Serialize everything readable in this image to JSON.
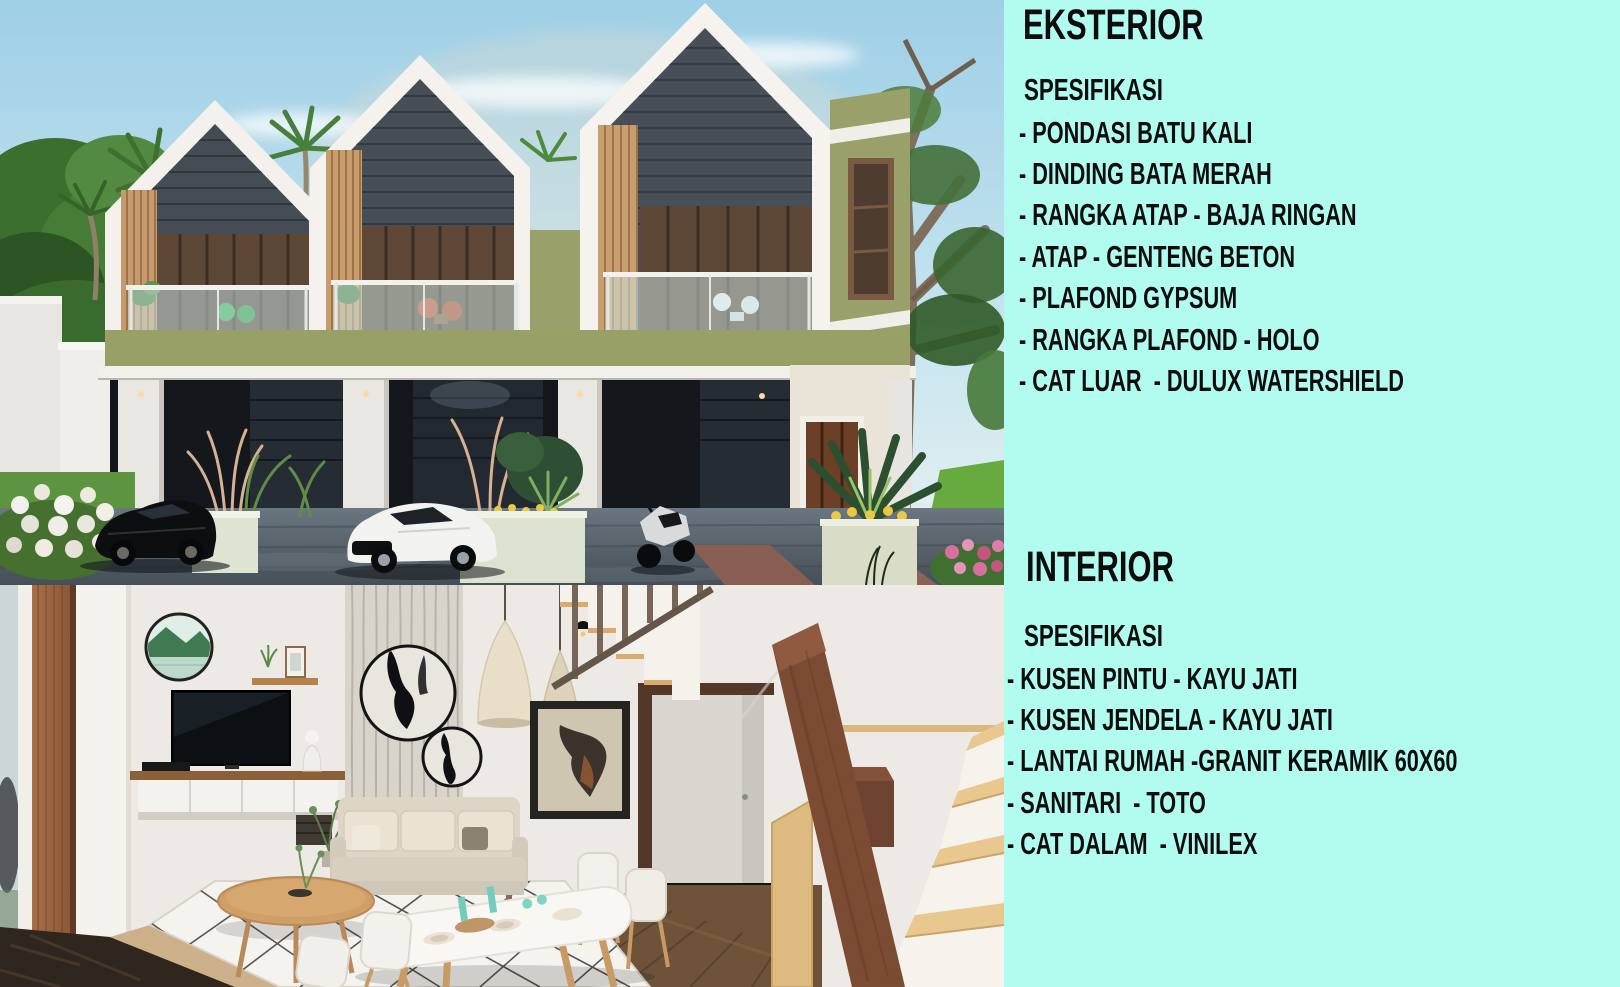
{
  "panel": {
    "background_color": "#B2FCEF",
    "text_color": "#0D0D0D",
    "eksterior": {
      "title": "EKSTERIOR",
      "subtitle": "SPESIFIKASI",
      "items": [
        "- PONDASI BATU KALI",
        "- DINDING BATA MERAH",
        "- RANGKA ATAP - BAJA RINGAN",
        "- ATAP - GENTENG BETON",
        "- PLAFOND GYPSUM",
        "- RANGKA PLAFOND - HOLO",
        "- CAT LUAR  - DULUX WATERSHIELD"
      ]
    },
    "interior": {
      "title": "INTERIOR",
      "subtitle": "SPESIFIKASI",
      "items": [
        "- KUSEN PINTU - KAYU JATI",
        "- KUSEN JENDELA - KAYU JATI",
        "- LANTAI RUMAH -GRANIT KERAMIK 60X60",
        "- SANITARI  - TOTO",
        "- CAT DALAM  - VINILEX"
      ]
    }
  }
}
